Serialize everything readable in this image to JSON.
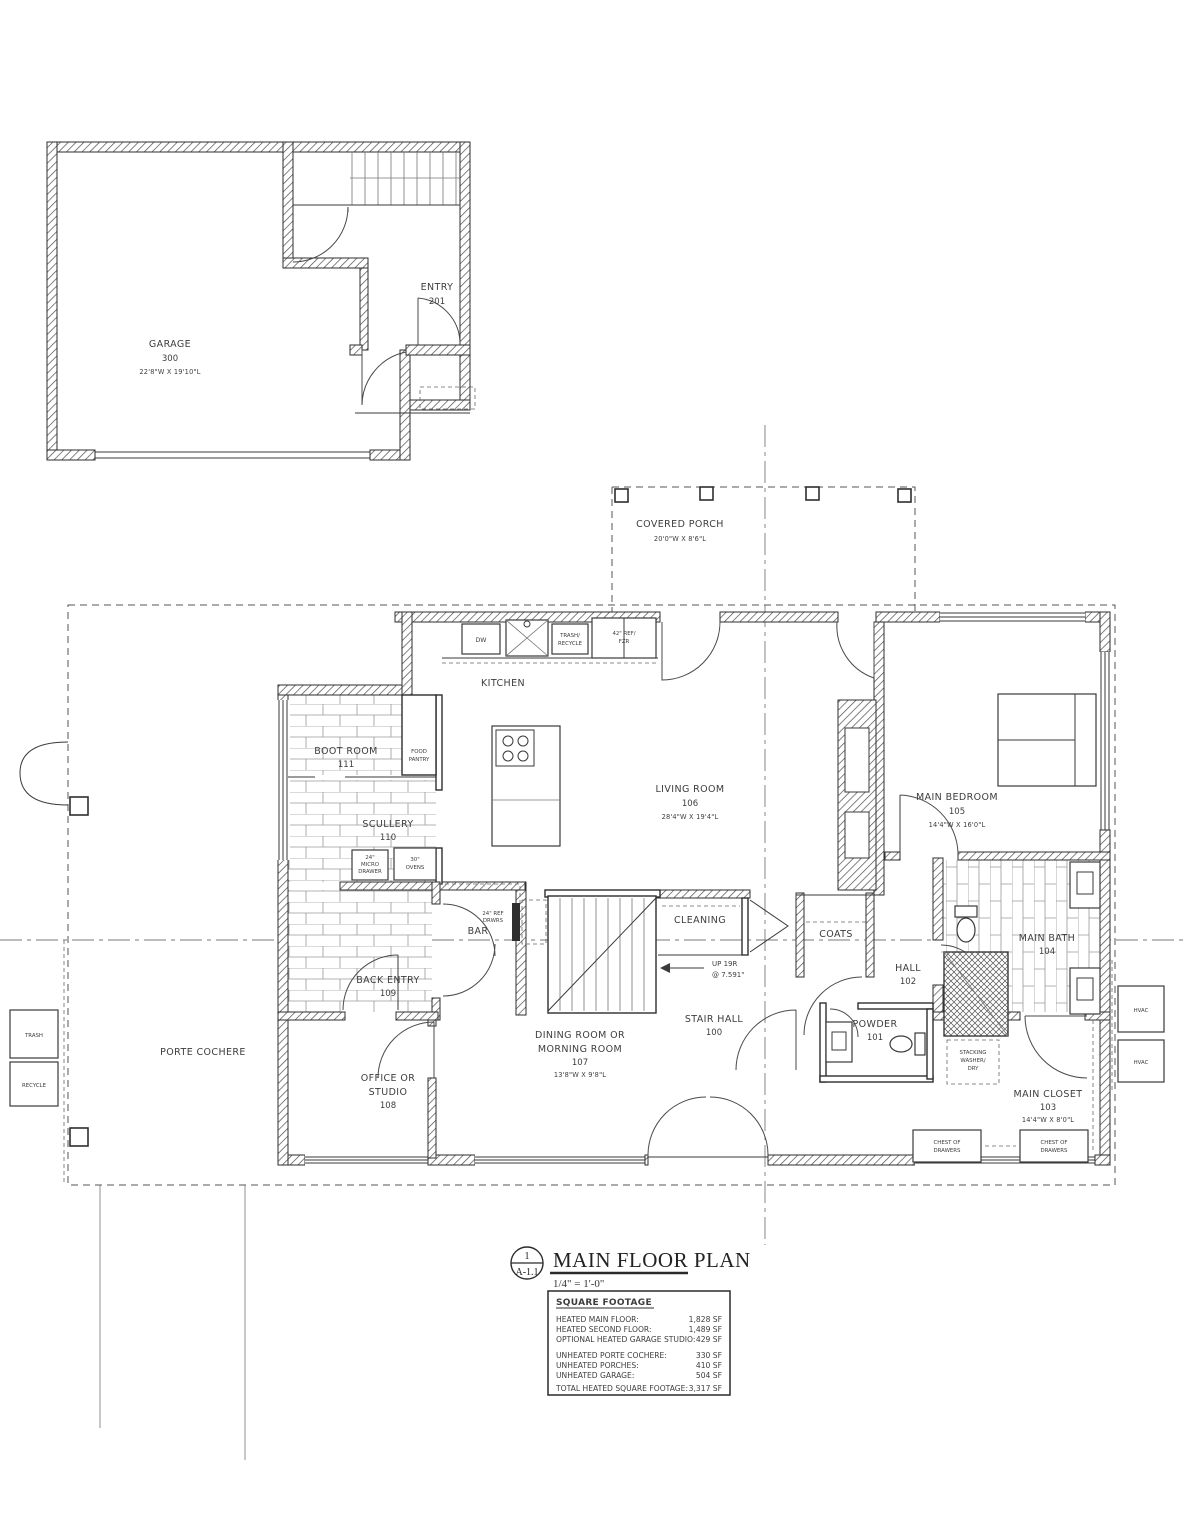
{
  "rooms": {
    "garage": [
      "GARAGE",
      "300",
      "22'8\"W X 19'10\"L"
    ],
    "entry": [
      "ENTRY",
      "201"
    ],
    "covered_porch": [
      "COVERED PORCH",
      "20'0\"W X 8'6\"L"
    ],
    "kitchen": [
      "KITCHEN"
    ],
    "living_room": [
      "LIVING ROOM",
      "106",
      "28'4\"W X 19'4\"L"
    ],
    "main_bedroom": [
      "MAIN BEDROOM",
      "105",
      "14'4\"W X 16'0\"L"
    ],
    "boot_room": [
      "BOOT ROOM",
      "111"
    ],
    "food_pantry": [
      "FOOD",
      "PANTRY"
    ],
    "scullery": [
      "SCULLERY",
      "110"
    ],
    "back_entry": [
      "BACK ENTRY",
      "109"
    ],
    "bar": [
      "BAR"
    ],
    "cleaning": [
      "CLEANING"
    ],
    "coats": [
      "COATS"
    ],
    "hall": [
      "HALL",
      "102"
    ],
    "stair_hall": [
      "STAIR HALL",
      "100"
    ],
    "powder": [
      "POWDER",
      "101"
    ],
    "main_bath": [
      "MAIN BATH",
      "104"
    ],
    "main_closet": [
      "MAIN CLOSET",
      "103",
      "14'4\"W X 8'0\"L"
    ],
    "dining": [
      "DINING ROOM OR",
      "MORNING ROOM",
      "107",
      "13'8\"W X 9'8\"L"
    ],
    "office": [
      "OFFICE OR",
      "STUDIO",
      "108"
    ],
    "porte_cochere": [
      "PORTE COCHERE"
    ]
  },
  "fixtures": {
    "dw": "DW",
    "trash_recycle": [
      "TRASH/",
      "RECYCLE"
    ],
    "fridge": [
      "42\" REF/",
      "FZR"
    ],
    "micro_drawer": [
      "24\"",
      "MICRO",
      "DRAWER"
    ],
    "ovens": [
      "30\"",
      "OVENS"
    ],
    "ref_drawers": [
      "24\" REF",
      "DRWRS"
    ],
    "stair_note": [
      "UP 19R",
      "@ 7.591\""
    ],
    "washer": [
      "STACKING",
      "WASHER/",
      "DRY"
    ],
    "chest": [
      "CHEST OF",
      "DRAWERS"
    ],
    "trash_bin": "TRASH",
    "recycle_bin": "RECYCLE",
    "hvac": "HVAC"
  },
  "title_block": {
    "detail_number": "1",
    "sheet_ref": "A-1.1",
    "title": "MAIN FLOOR PLAN",
    "scale": "1/4\" = 1'-0\""
  },
  "square_footage": {
    "heading": "SQUARE FOOTAGE",
    "rows": [
      {
        "label": "HEATED MAIN FLOOR:",
        "value": "1,828 SF"
      },
      {
        "label": "HEATED SECOND FLOOR:",
        "value": "1,489 SF"
      },
      {
        "label": "OPTIONAL HEATED GARAGE STUDIO:",
        "value": "429 SF"
      },
      {
        "label": "UNHEATED PORTE COCHERE:",
        "value": "330 SF"
      },
      {
        "label": "UNHEATED PORCHES:",
        "value": "410 SF"
      },
      {
        "label": "UNHEATED GARAGE:",
        "value": "504 SF"
      },
      {
        "label": "TOTAL HEATED SQUARE FOOTAGE:",
        "value": "3,317 SF"
      }
    ]
  }
}
